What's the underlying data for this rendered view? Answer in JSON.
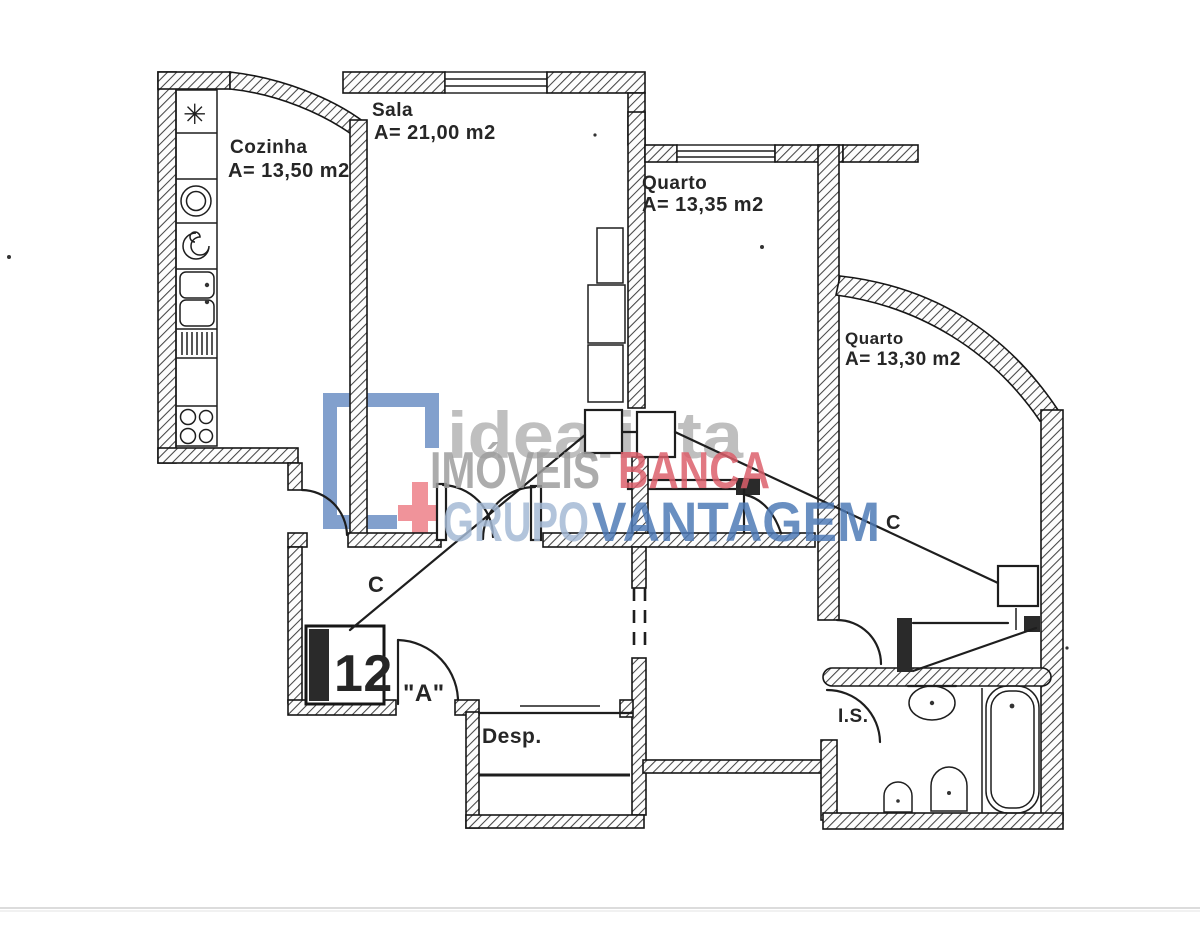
{
  "image_type": "scanned apartment floor plan (real-estate listing)",
  "plan": {
    "rooms": [
      {
        "name": "Cozinha",
        "area": "A= 13,50 m2"
      },
      {
        "name": "Sala",
        "area": "A= 21,00 m2"
      },
      {
        "name": "Quarto",
        "area": "A= 13,35 m2"
      },
      {
        "name": "Quarto",
        "area": "A= 13,30 m2"
      },
      {
        "name": "Desp."
      },
      {
        "name": "I.S."
      }
    ],
    "annotations": {
      "closet_label_left": "C",
      "closet_label_right": "C",
      "entrance_door_label": "\"A\"",
      "unit_number": "12"
    }
  },
  "watermark": {
    "brand_name": "idealista",
    "word_imoveis": "IMÓVEIS",
    "word_banca": "BANCA",
    "word_grupo": "GRUPO",
    "word_vantagem": "VANTAGEM",
    "colors": {
      "brand_gray": "#b4b4b4",
      "imoveis_gray": "#9d9d9d",
      "banca_red": "#dc5f6b",
      "grupo_light_blue": "#a4b9d5",
      "vantagem_blue": "#4d7ab6",
      "bracket_blue": "#7b9bca",
      "plus_red": "#ef8a92"
    }
  }
}
